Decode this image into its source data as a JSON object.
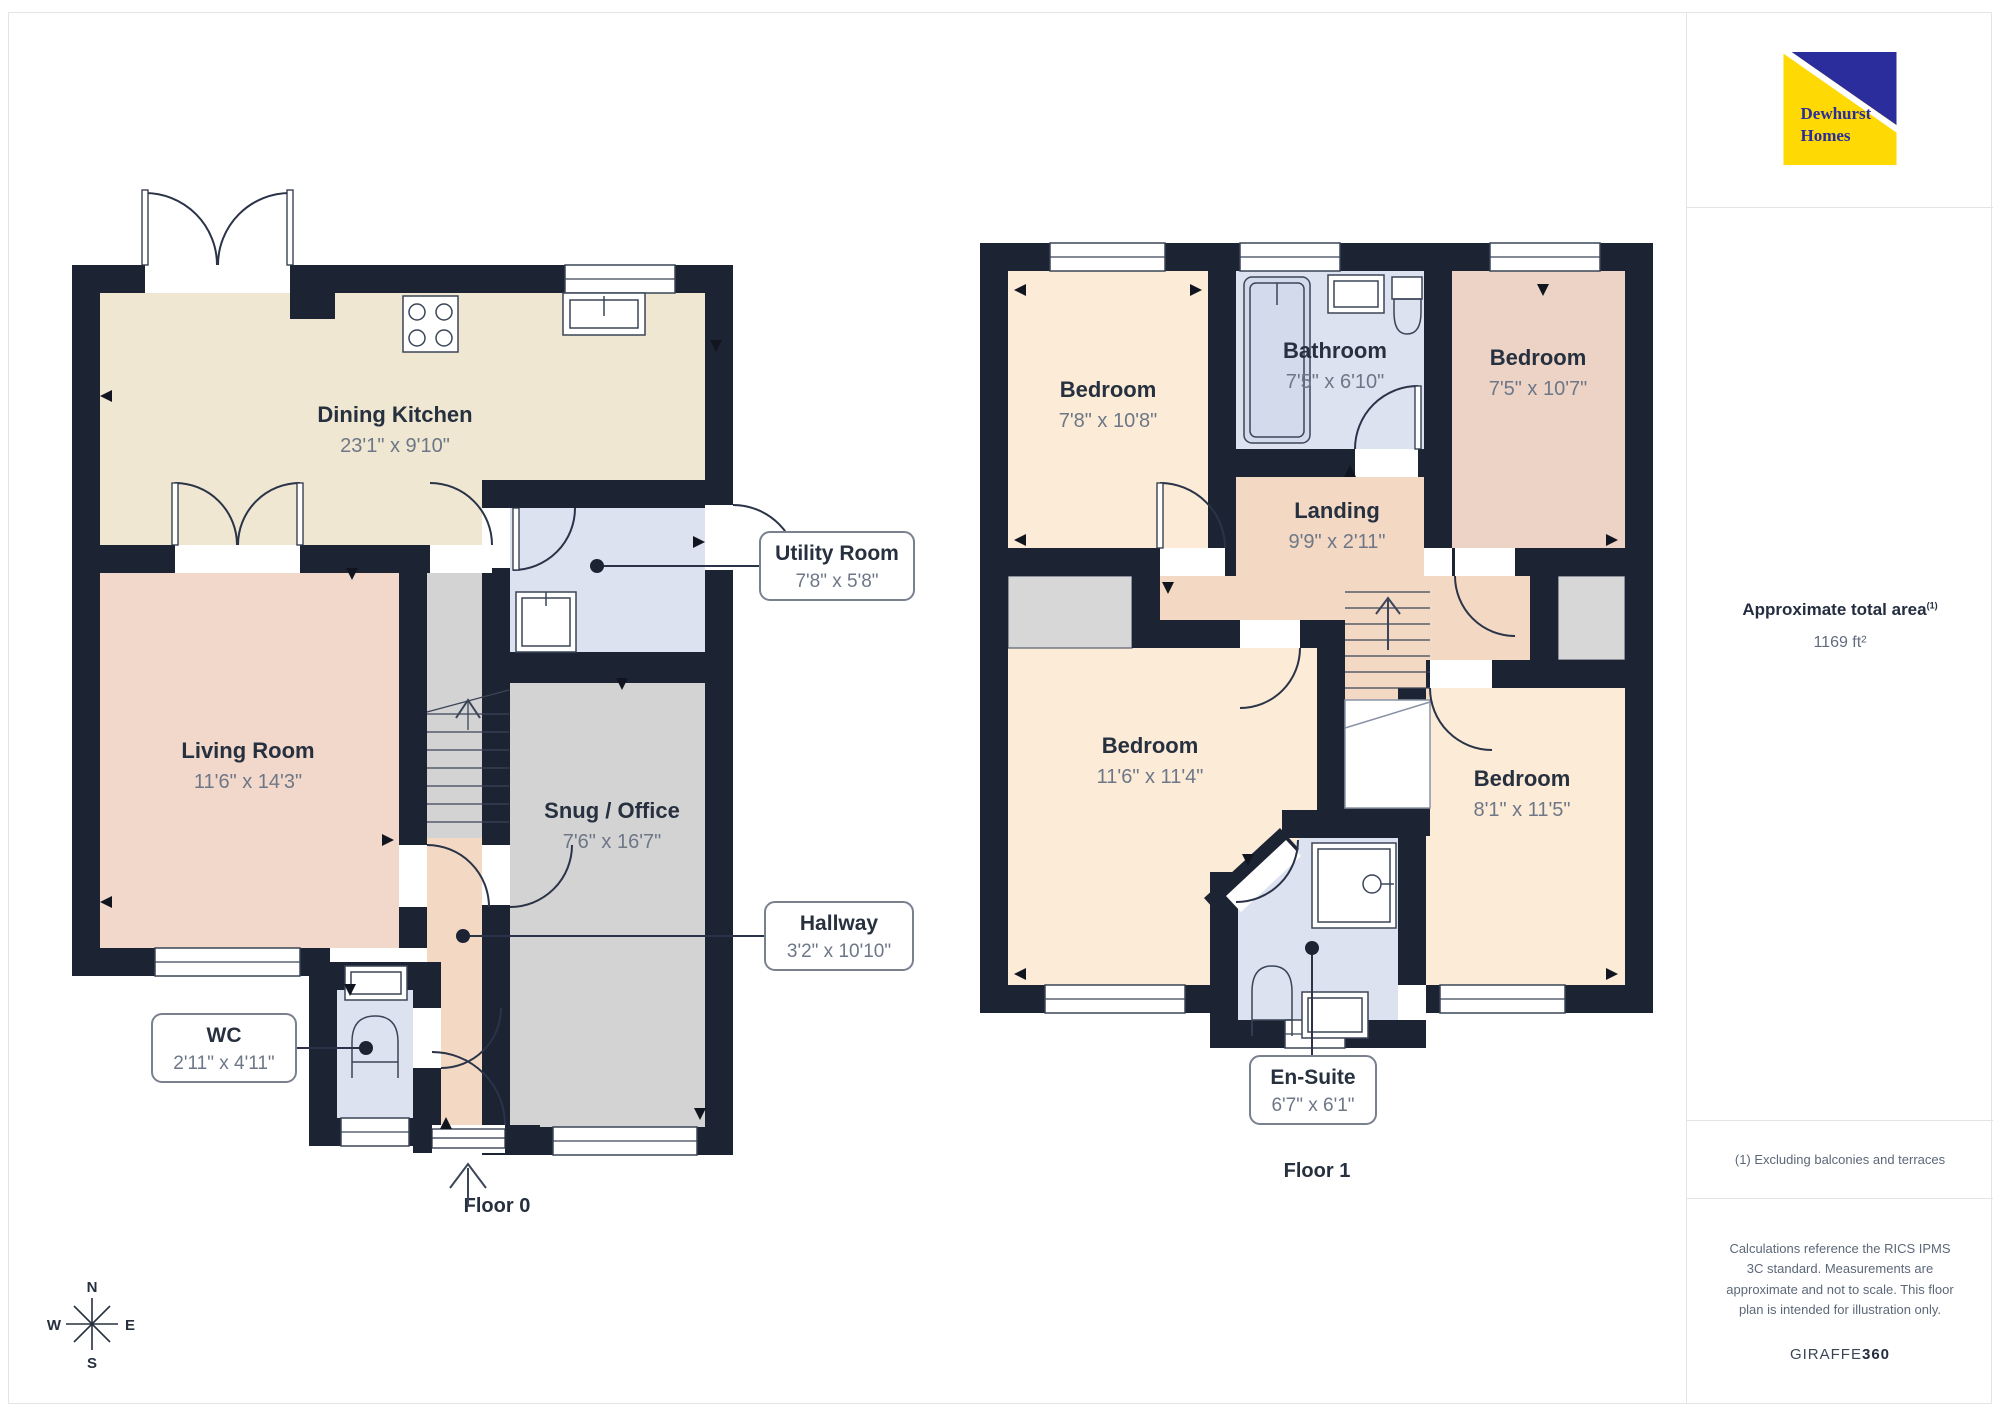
{
  "branding": {
    "logo_line1": "Dewhurst",
    "logo_line2": "Homes",
    "logo_yellow": "#FFD903",
    "logo_blue": "#2A2D9B"
  },
  "panel": {
    "area_title": "Approximate total area",
    "area_ref": "(1)",
    "area_value": "1169 ft²",
    "footnote": "(1) Excluding balconies and terraces",
    "disclaimer": "Calculations reference the RICS IPMS 3C standard. Measurements are approximate and not to scale. This floor plan is intended for illustration only.",
    "brand_name": "GIRAFFE",
    "brand_suffix": "360"
  },
  "compass": {
    "n": "N",
    "e": "E",
    "s": "S",
    "w": "W"
  },
  "floor0": {
    "label": "Floor 0",
    "rooms": {
      "dining_kitchen": {
        "name": "Dining Kitchen",
        "dims": "23'1\" x 9'10\""
      },
      "living_room": {
        "name": "Living Room",
        "dims": "11'6\" x 14'3\""
      },
      "snug_office": {
        "name": "Snug / Office",
        "dims": "7'6\" x 16'7\""
      }
    },
    "callouts": {
      "utility": {
        "name": "Utility Room",
        "dims": "7'8\" x 5'8\""
      },
      "hallway": {
        "name": "Hallway",
        "dims": "3'2\" x 10'10\""
      },
      "wc": {
        "name": "WC",
        "dims": "2'11\" x 4'11\""
      }
    }
  },
  "floor1": {
    "label": "Floor 1",
    "rooms": {
      "bedroom_tl": {
        "name": "Bedroom",
        "dims": "7'8\" x 10'8\""
      },
      "bathroom": {
        "name": "Bathroom",
        "dims": "7'5\" x 6'10\""
      },
      "bedroom_tr": {
        "name": "Bedroom",
        "dims": "7'5\" x 10'7\""
      },
      "landing": {
        "name": "Landing",
        "dims": "9'9\" x 2'11\""
      },
      "bedroom_bl": {
        "name": "Bedroom",
        "dims": "11'6\" x 11'4\""
      },
      "bedroom_br": {
        "name": "Bedroom",
        "dims": "8'1\" x 11'5\""
      }
    },
    "callouts": {
      "ensuite": {
        "name": "En-Suite",
        "dims": "6'7\" x 6'1\""
      }
    }
  },
  "colors": {
    "wall": "#1C2433",
    "kitchen": "#EFE7D1",
    "living_pink": "#F2D8CA",
    "landing_pink": "#F3D9C4",
    "bedroom_cream": "#FBEBD7",
    "bedroom_pink": "#ECD3C5",
    "wet_room_blue": "#DDE2F0",
    "snug_gray": "#D3D3D4"
  }
}
